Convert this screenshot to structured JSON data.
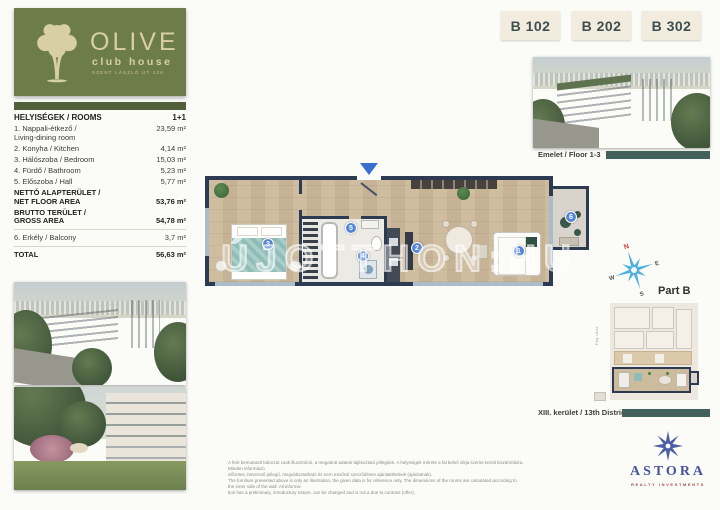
{
  "logo": {
    "name": "OLIVE",
    "subtitle": "club house",
    "tagline": "SZENT LÁSZLÓ ÚT 106"
  },
  "unit_tabs": [
    {
      "label": "B 102"
    },
    {
      "label": "B 202"
    },
    {
      "label": "B 302"
    }
  ],
  "rooms_table": {
    "header_label": "HELYISÉGEK / ROOMS",
    "header_value": "1+1",
    "rows": [
      {
        "label": "1. Nappali-étkező /\nLiving-dining room",
        "value": "23,59 m²"
      },
      {
        "label": "2. Konyha / Kitchen",
        "value": "4,14 m²"
      },
      {
        "label": "3. Hálószoba / Bedroom",
        "value": "15,03 m²"
      },
      {
        "label": "4. Fürdő / Bathroom",
        "value": "5,23 m²"
      },
      {
        "label": "5. Előszoba / Hall",
        "value": "5,77 m²"
      },
      {
        "label": "NETTÓ ALAPTERÜLET /\nNET FLOOR AREA",
        "value": "53,76 m²"
      },
      {
        "label": "BRUTTO TERÜLET /\nGROSS AREA",
        "value": "54,78 m²"
      },
      {
        "label": "6. Erkély / Balcony",
        "value": "3,7 m²"
      },
      {
        "label": "TOTAL",
        "value": "56,63 m²"
      }
    ]
  },
  "captions": {
    "floor_photo": "Emelet / Floor 1-3",
    "district": "XIII. kerület / 13th District"
  },
  "floor_plan": {
    "watermark": "ÚJOTTHON:HU",
    "markers": [
      {
        "n": "1",
        "room": "living-dining"
      },
      {
        "n": "2",
        "room": "kitchen"
      },
      {
        "n": "3",
        "room": "bedroom"
      },
      {
        "n": "4",
        "room": "bathroom"
      },
      {
        "n": "5",
        "room": "hall"
      },
      {
        "n": "6",
        "room": "balcony"
      }
    ]
  },
  "compass": {
    "n": "N",
    "e": "E",
    "s": "S",
    "w": "W"
  },
  "part_label": "Part B",
  "key_plan": {
    "street_label": "Fáy utca"
  },
  "disclaimer": {
    "lines": [
      "A fent bemutatott bútorzat csak illusztráció, a megadott adatok tájékoztató jellegűek. A helyiségek mérete a fal belső síkja szerint került kiszámításra. Minden információ",
      "előzetes, bevezető jellegű, megváltoztatható és nem minősül szerződéses ajánlattételnek (ajánlatnak).",
      "The furniture presented above is only an illustration, the given data is for reference only. The dimensions of the rooms are calculated according to the inner side of the wall. All informa-",
      "tion has a preliminary, introductory nature, can be changed and is not a due to contract (offer)."
    ]
  },
  "astora": {
    "name": "ASTORA",
    "subtitle": "REALTY INVESTMENTS"
  },
  "colors": {
    "logo_green": "#6d7c4b",
    "logo_bar_green": "#525f3a",
    "tab_bg": "#f2ecdf",
    "tab_text": "#3e4e4f",
    "teal_bar": "#43605a",
    "wall_navy": "#2d3b52",
    "wood_floor": "#cbb795",
    "marker_blue": "#5585d8",
    "compass_blue": "#4fb0e0",
    "astora_blue": "#47549b",
    "astora_red": "#a04848"
  }
}
